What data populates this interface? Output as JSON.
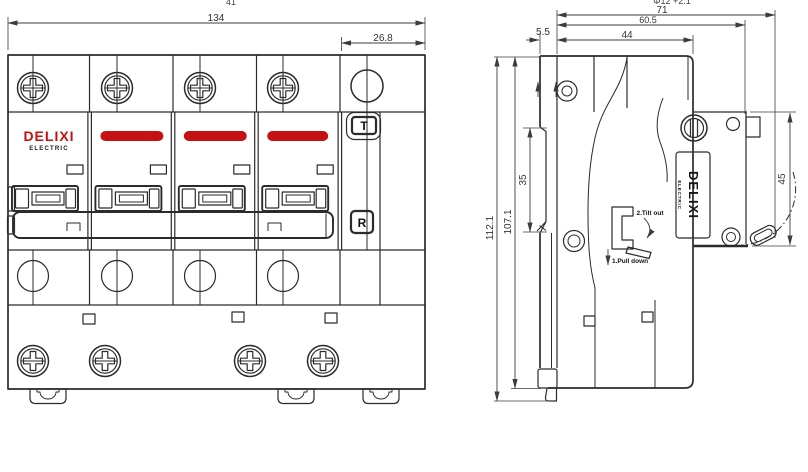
{
  "front_view": {
    "dims": {
      "width_total": "134",
      "module_width": "26.8",
      "clipped_top": "41"
    },
    "logo": {
      "brand": "DELIXI",
      "sub": "ELECTRIC"
    },
    "buttons": {
      "test": "T",
      "reset": "R"
    }
  },
  "side_view": {
    "dims": {
      "depth_total": "71",
      "depth_body": "60.5",
      "depth_front": "44",
      "rail_offset": "5.5",
      "height_total": "112.1",
      "height_body": "107.1",
      "rail_slot": "35",
      "terminal_zone": "45"
    },
    "clipped_note": "Φ12 +2.1",
    "logo": {
      "brand": "DELIXI",
      "sub": "ELECTRIC"
    },
    "instructions": {
      "step1": "1.Pull down",
      "step2": "2.Tilt out"
    }
  }
}
